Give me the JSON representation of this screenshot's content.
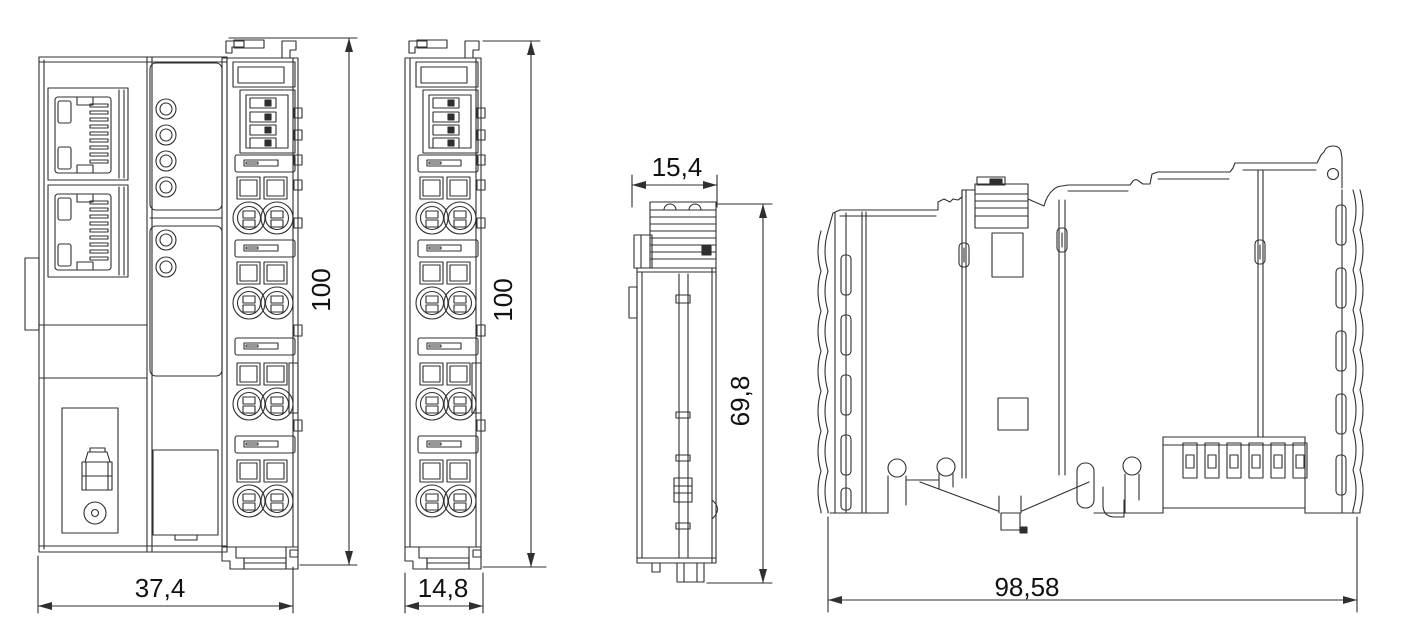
{
  "colors": {
    "line": "#2f2f2f",
    "text": "#111111",
    "background": "#ffffff"
  },
  "views": {
    "coupler_front": {
      "width_dim": "37,4",
      "height_dim": "100"
    },
    "terminal_front": {
      "width_dim": "14,8",
      "height_dim": "100"
    },
    "terminal_side": {
      "top_width_dim": "15,4",
      "height_dim": "69,8"
    },
    "module_side": {
      "width_dim": "98,58"
    }
  }
}
